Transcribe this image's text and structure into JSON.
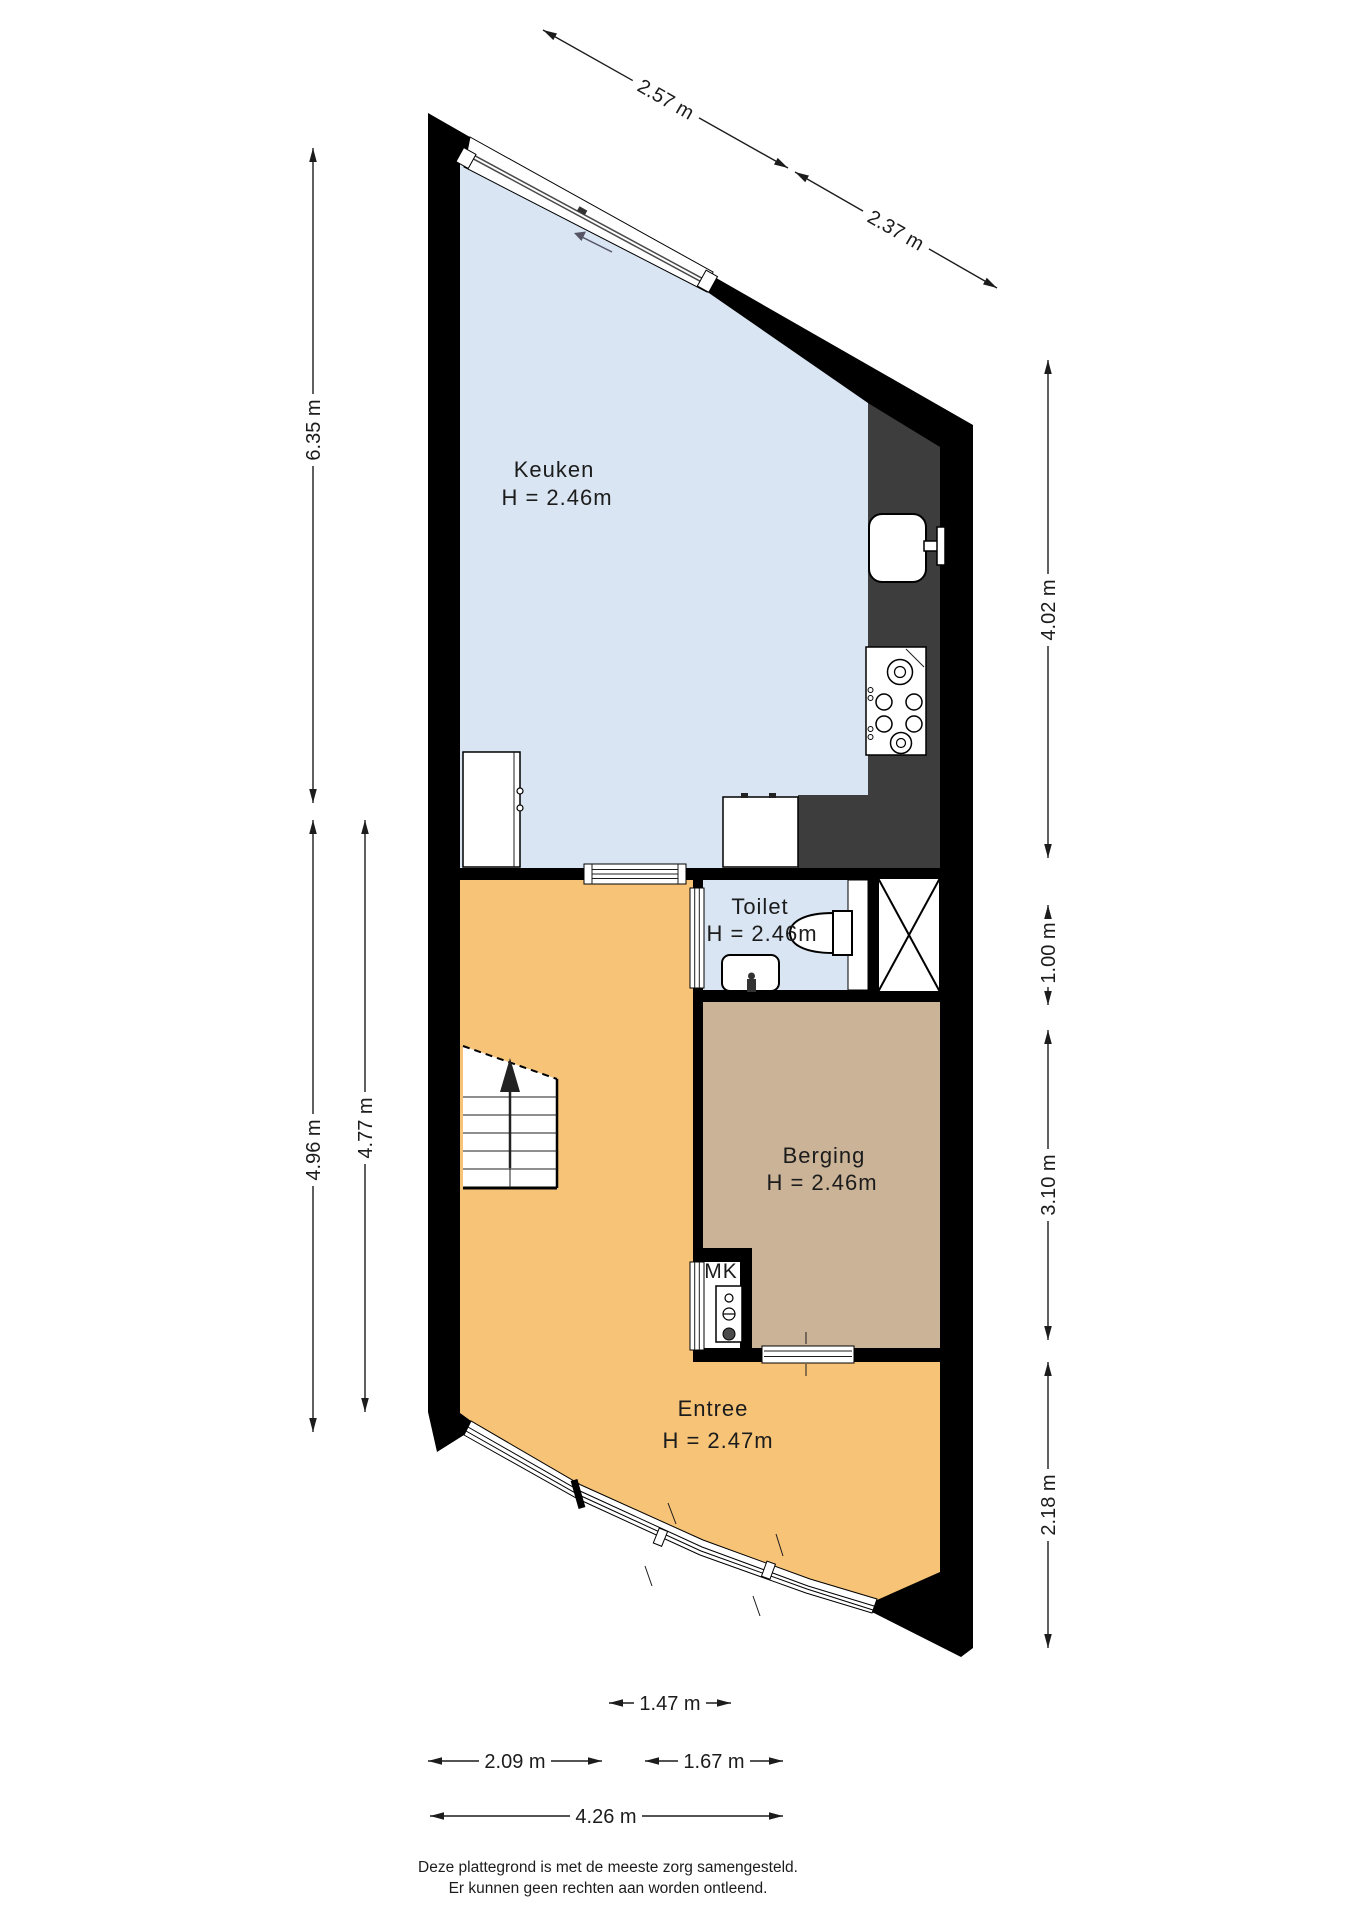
{
  "rooms": {
    "keuken": {
      "name": "Keuken",
      "height": "H = 2.46m"
    },
    "toilet": {
      "name": "Toilet",
      "height": "H = 2.46m"
    },
    "berging": {
      "name": "Berging",
      "height": "H = 2.46m"
    },
    "entree": {
      "name": "Entree",
      "height": "H = 2.47m"
    },
    "mk": {
      "name": "MK"
    }
  },
  "dims": {
    "d257": "2.57 m",
    "d237": "2.37 m",
    "d635": "6.35 m",
    "d496": "4.96 m",
    "d477": "4.77 m",
    "d402": "4.02 m",
    "d100": "1.00 m",
    "d310": "3.10 m",
    "d218": "2.18 m",
    "d147": "1.47 m",
    "d209": "2.09 m",
    "d167": "1.67 m",
    "d426": "4.26 m"
  },
  "footer": {
    "line1": "Deze plattegrond is met de meeste zorg samengesteld.",
    "line2": "Er kunnen geen rechten aan worden ontleend."
  },
  "colors": {
    "wall": "#000000",
    "room_blue": "#d9e5f2",
    "room_orange": "#f6c377",
    "room_tan": "#cab397",
    "counter_dark": "#3d3d3d",
    "glazing": "#4a4a4a"
  }
}
